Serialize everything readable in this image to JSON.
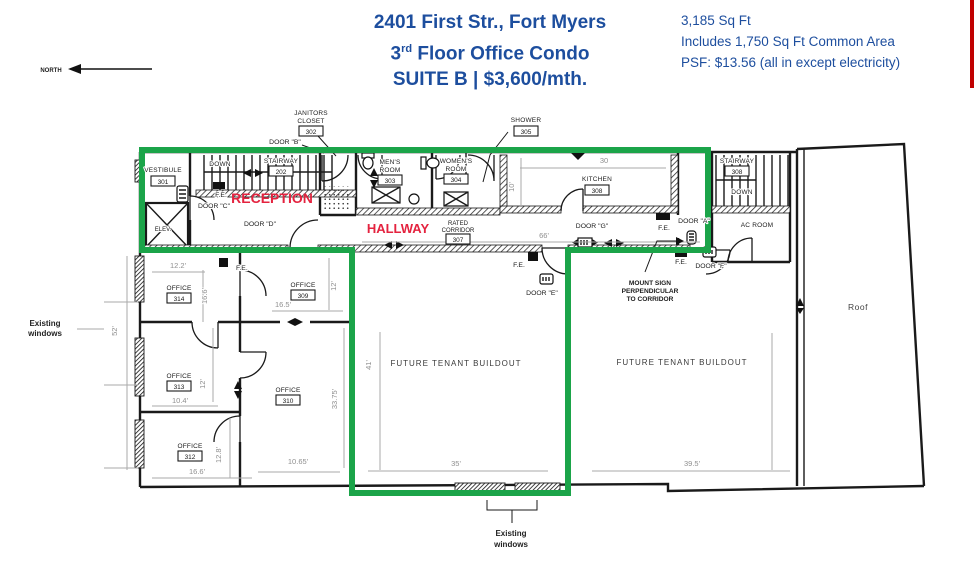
{
  "header": {
    "title_line1": "2401 First Str., Fort Myers",
    "title_line2_num": "3",
    "title_line2_sup": "rd",
    "title_line2_rest": " Floor Office Condo",
    "title_line3": "SUITE B | $3,600/mth.",
    "area_line1": "3,185 Sq Ft",
    "area_line2": "Includes 1,750 Sq Ft Common Area",
    "area_line3": "PSF: $13.56 (all in except electricity)"
  },
  "compass": {
    "north": "NORTH"
  },
  "rooms": {
    "vestibule": "VESTIBULE",
    "vestibule_num": "301",
    "stair_left": "STAIRWAY",
    "stair_left_num": "202",
    "stair_left_down": "DOWN",
    "janitors_l1": "JANITORS",
    "janitors_l2": "CLOSET",
    "janitors_num": "302",
    "mens_l1": "MEN'S",
    "mens_l2": "ROOM",
    "mens_num": "303",
    "womens_l1": "WOMEN'S",
    "womens_l2": "ROOM",
    "womens_num": "304",
    "shower": "SHOWER",
    "shower_num": "305",
    "kitchen": "KITCHEN",
    "kitchen_num": "308",
    "corridor_l1": "RATED",
    "corridor_l2": "CORRIDOR",
    "corridor_num": "307",
    "stair_right": "STAIRWAY",
    "stair_right_num": "308",
    "stair_right_down": "DOWN",
    "ac_room": "AC ROOM",
    "reception": "RECEPTION",
    "hallway": "HALLWAY",
    "elevator": "ELEV.",
    "office": "OFFICE",
    "office314_num": "314",
    "office313_num": "313",
    "office312_num": "312",
    "office309_num": "309",
    "office310_num": "310",
    "buildout": "FUTURE TENANT BUILDOUT",
    "roof": "Roof"
  },
  "doors": {
    "a": "DOOR \"A\"",
    "b": "DOOR \"B\"",
    "c": "DOOR \"C\"",
    "d": "DOOR \"D\"",
    "e": "DOOR \"E\"",
    "f": "DOOR \"F\"",
    "g": "DOOR \"G\""
  },
  "labels": {
    "fe": "F.E.",
    "existing_l1": "Existing",
    "existing_l2": "windows",
    "mount_l1": "MOUNT SIGN",
    "mount_l2": "PERPENDICULAR",
    "mount_l3": "TO CORRIDOR"
  },
  "dims": {
    "o314_w": "12.2'",
    "o314_h": "16.6'",
    "o309_w": "16.5'",
    "o309_h": "12'",
    "o313_w": "10.4'",
    "o313_h": "12'",
    "o312_w": "16.6'",
    "o312_h": "12.8'",
    "o310_w": "10.65'",
    "o310_h": "33.75'",
    "center_h": "41'",
    "center_w": "35'",
    "right_w": "39.5'",
    "corridor_len": "66'",
    "kitchen_w": "30",
    "kitchen_h": "10'",
    "windows_h": "52'"
  },
  "colors": {
    "accent_blue": "#1d4e9e",
    "accent_red": "#e4233f",
    "suite_green": "#1ba449",
    "edge_red": "#c00000"
  }
}
